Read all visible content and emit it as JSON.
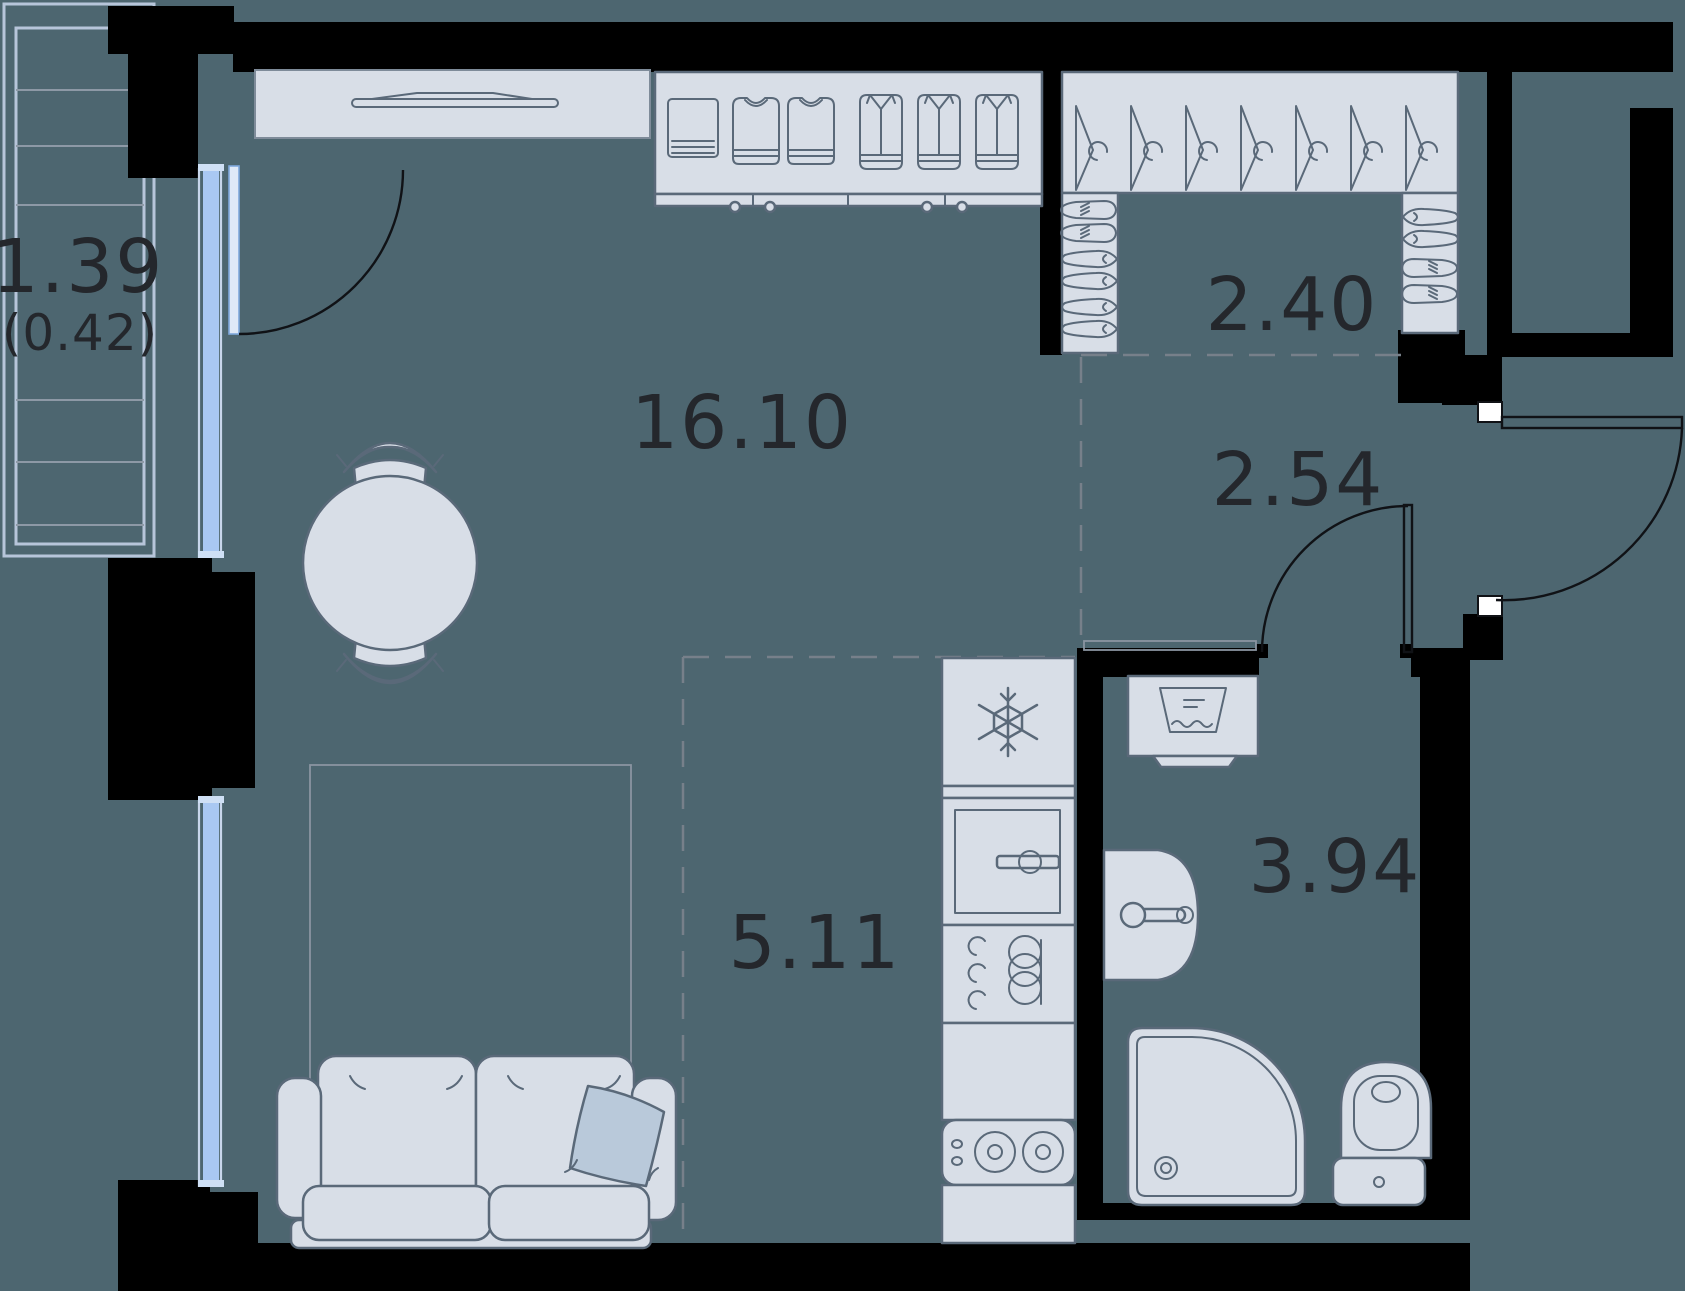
{
  "title": "Studio apartment floor plan",
  "colors": {
    "bg": "#4D6670",
    "wall": "#000000",
    "furniture-fill": "#D8DEE7",
    "furniture-stroke": "#5A6979",
    "outline-light": "#8A94A1",
    "window-glass": "#A9C8F2",
    "window-frame": "#C8D6EB",
    "balcony-frame": "#B7C5DA",
    "dash": "#77808A",
    "pillow": "#B9C9DA",
    "label": "#24272C"
  },
  "rooms": [
    {
      "name": "balcony",
      "area": "1.39",
      "area_secondary": "(0.42)"
    },
    {
      "name": "living-room",
      "area": "16.10"
    },
    {
      "name": "wardrobe-closet",
      "area": "2.40"
    },
    {
      "name": "hallway",
      "area": "2.54"
    },
    {
      "name": "kitchen",
      "area": "5.11"
    },
    {
      "name": "bathroom",
      "area": "3.94"
    }
  ]
}
